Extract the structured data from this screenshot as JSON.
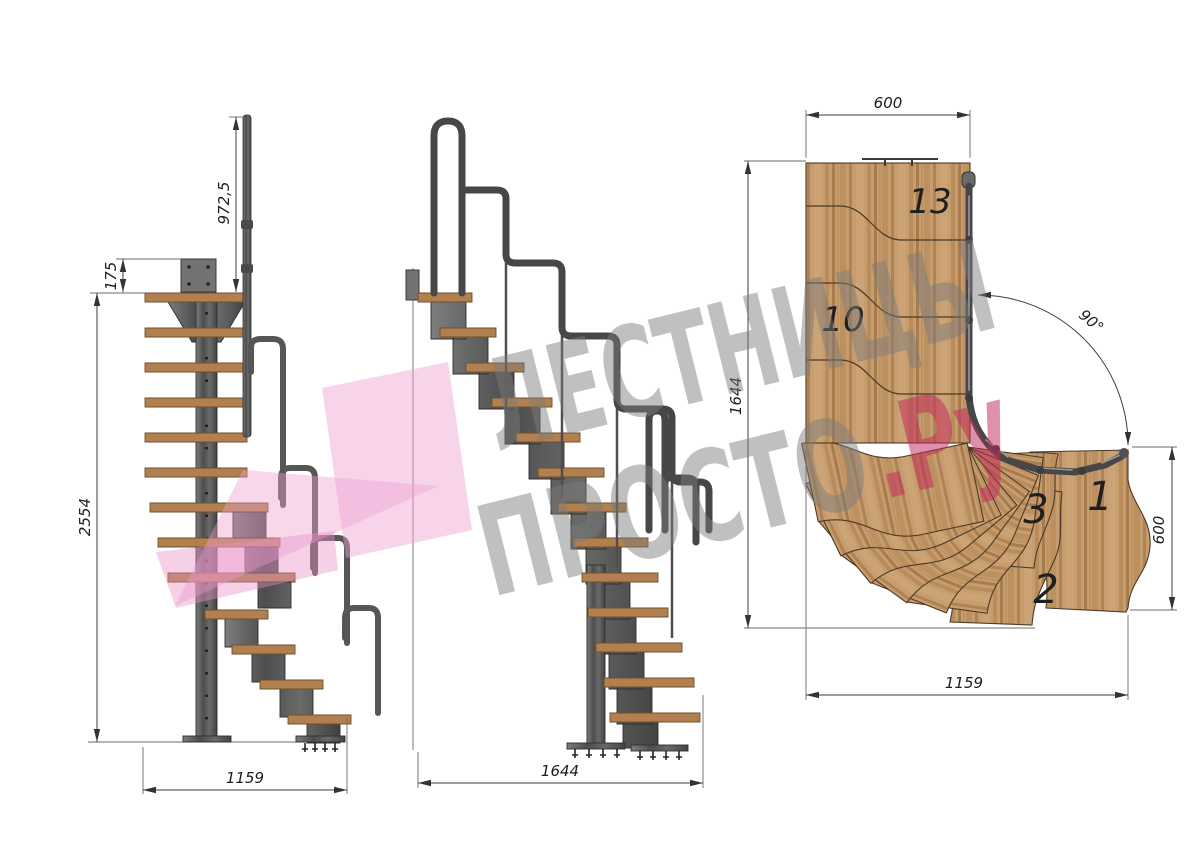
{
  "drawing_title": "Modular staircase with 90 degree turn - three projection views",
  "left_view": {
    "dim_rail_height": "972,5",
    "dim_plate_offset": "175",
    "dim_total_height": "2554",
    "dim_depth": "1159"
  },
  "middle_view": {
    "dim_run": "1644"
  },
  "plan_view": {
    "dim_top_width": "600",
    "dim_left_depth": "1644",
    "dim_right_depth": "600",
    "dim_bottom_width": "1159",
    "turn_angle": "90°",
    "steps": {
      "s13": "13",
      "s10": "10",
      "s3": "3",
      "s1": "1",
      "s2": "2"
    }
  },
  "watermark": {
    "line1": "ЛЕСТНИЦЫ",
    "line2": "ПРОСТО",
    "suffix": ".Ру"
  },
  "colors": {
    "wood": "#c59a6c",
    "wood_dark": "#9a713f",
    "tread_side": "#b1804e",
    "metal": "#5e5e5e",
    "metal_dark": "#2f2f2f",
    "watermark_pink": "#efa8d2",
    "watermark_accent": "#c63a67",
    "watermark_gray": "#7b7b7b",
    "dim_line": "#3c3c3c"
  }
}
